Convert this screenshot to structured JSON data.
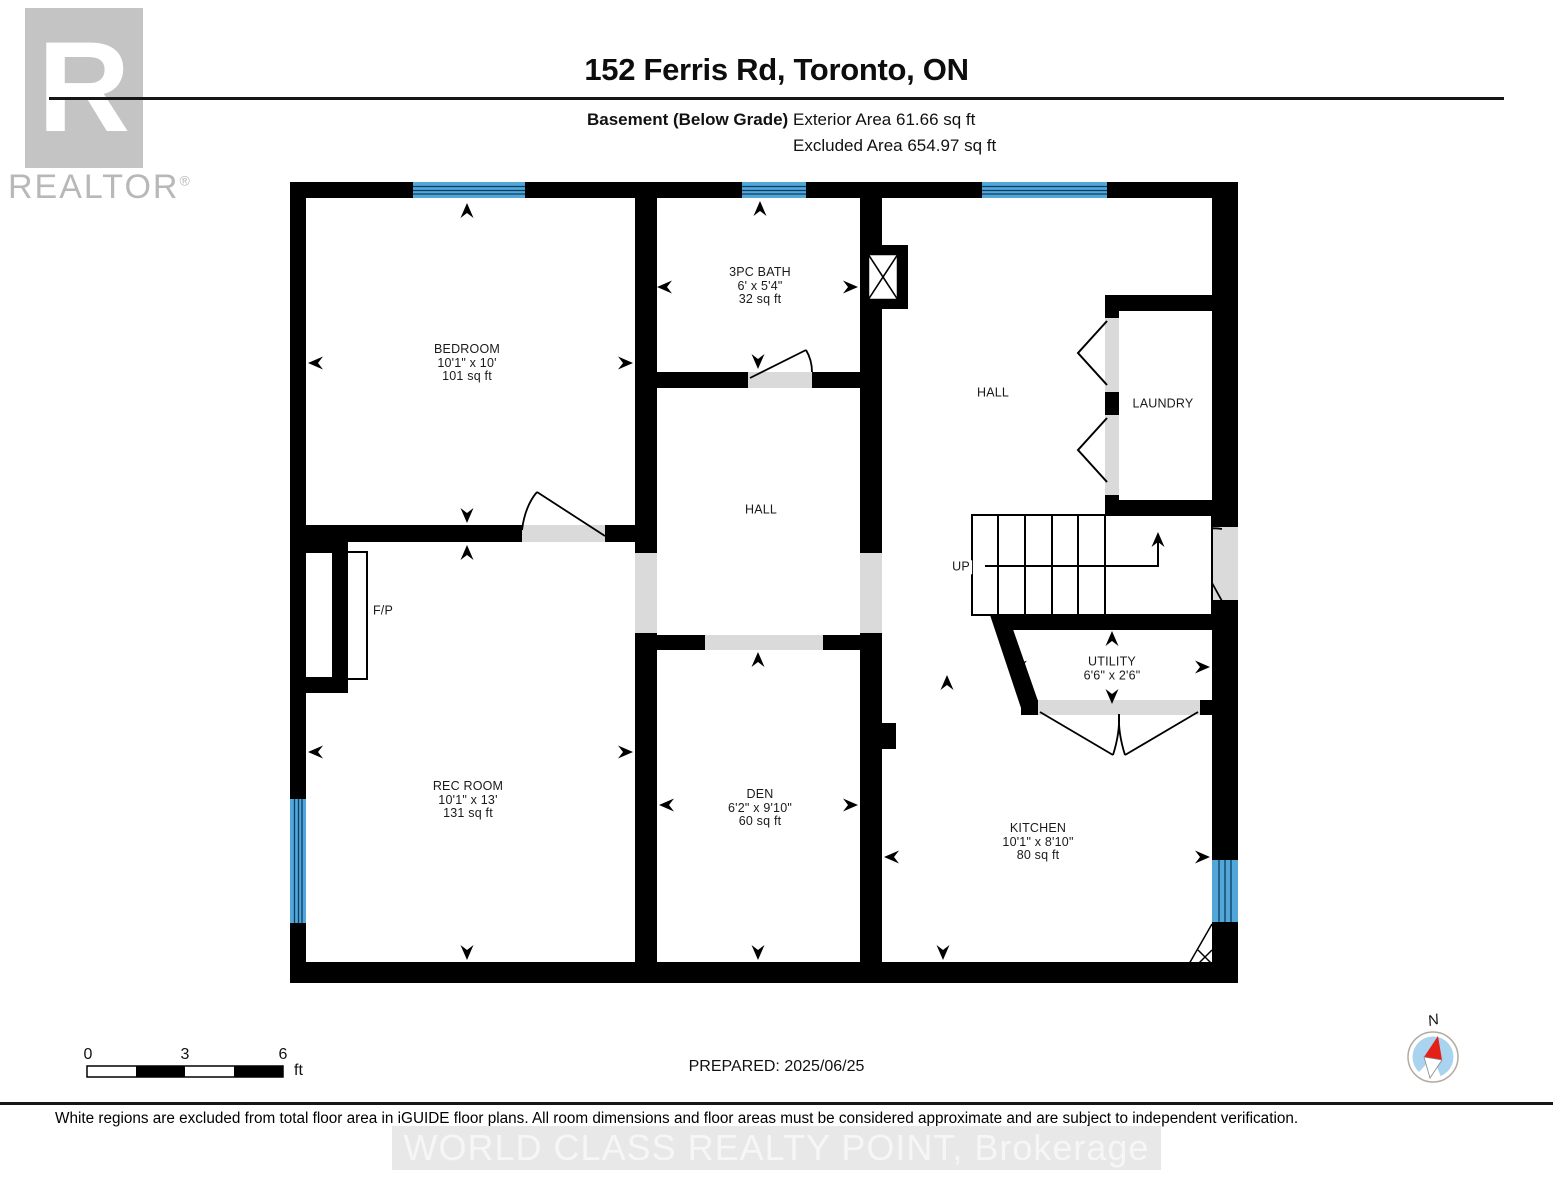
{
  "header": {
    "title": "152 Ferris Rd, Toronto, ON",
    "floor_label": "Basement (Below Grade)",
    "exterior_area": "Exterior Area 61.66 sq ft",
    "excluded_area": "Excluded Area 654.97 sq ft"
  },
  "logo": {
    "letter": "R",
    "brand": "REALTOR",
    "registered": "®"
  },
  "rooms": {
    "bedroom": {
      "name": "BEDROOM",
      "dims": "10'1\" x 10'",
      "area": "101 sq ft"
    },
    "bath": {
      "name": "3PC BATH",
      "dims": "6' x 5'4\"",
      "area": "32 sq ft"
    },
    "rec_room": {
      "name": "REC ROOM",
      "dims": "10'1\" x 13'",
      "area": "131 sq ft"
    },
    "den": {
      "name": "DEN",
      "dims": "6'2\" x 9'10\"",
      "area": "60 sq ft"
    },
    "kitchen": {
      "name": "KITCHEN",
      "dims": "10'1\" x 8'10\"",
      "area": "80 sq ft"
    },
    "utility": {
      "name": "UTILITY",
      "dims": "6'6\" x 2'6\""
    },
    "hall_center": {
      "name": "HALL"
    },
    "hall_right": {
      "name": "HALL"
    },
    "laundry": {
      "name": "LAUNDRY"
    },
    "fireplace": {
      "name": "F/P"
    },
    "stairs": {
      "name": "UP"
    }
  },
  "scale_bar": {
    "start": "0",
    "mid": "3",
    "end": "6",
    "unit": "ft"
  },
  "prepared": "PREPARED: 2025/06/25",
  "compass": {
    "north": "N"
  },
  "footer": {
    "disclaimer": "White regions are excluded from total floor area in iGUIDE floor plans. All room dimensions and floor areas must be considered approximate and are subject to independent verification.",
    "watermark": "WORLD CLASS REALTY POINT, Brokerage"
  },
  "colors": {
    "wall": "#000000",
    "window_fill": "#53a6d8",
    "window_line": "#0a3e63",
    "opening_gray": "#dadada",
    "logo_gray": "#c4c4c4",
    "compass_blue": "#a9d3ee",
    "needle_red": "#e32119"
  }
}
